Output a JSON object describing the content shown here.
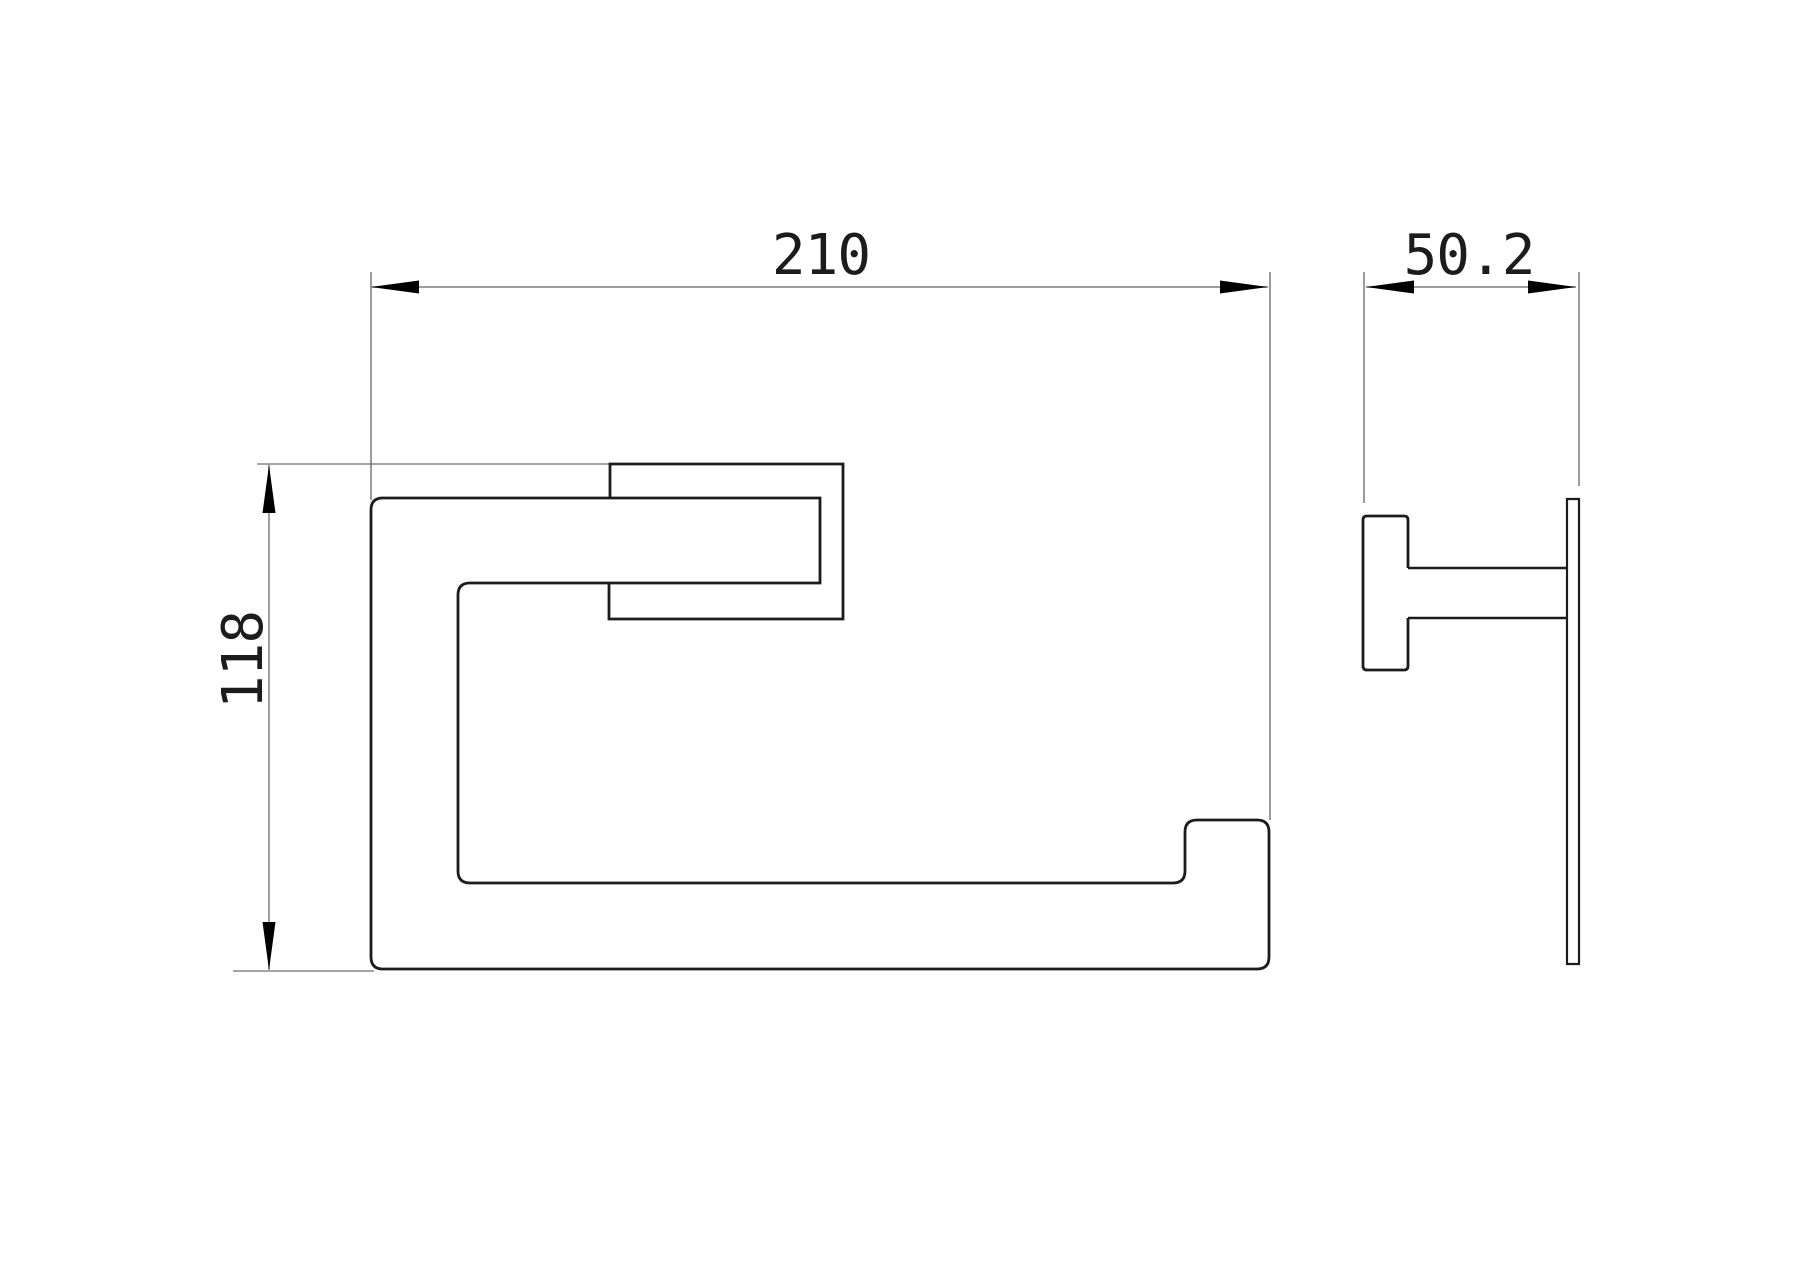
{
  "colors": {
    "background": "#ffffff",
    "outline": "#1c1c1c",
    "ext_line": "#4a4a4a",
    "dim_line": "#8f8f8f",
    "arrow": "#000000",
    "text": "#1c1c1c"
  },
  "dimensions": [
    {
      "id": "overall-width",
      "label": "210"
    },
    {
      "id": "overall-height",
      "label": "118"
    },
    {
      "id": "overall-depth",
      "label": "50.2"
    }
  ],
  "front_view": {
    "segments": [
      {
        "name": "bar-outline",
        "d": "M 820 498 L 383 498 Q 371 498 371 510 L 371 957 Q 371 969 383 969 L 1257 969 Q 1269 969 1269 957 L 1269 832 Q 1269 820 1257 820 L 1197 820 Q 1185 820 1185 832 L 1185 871 Q 1185 883 1173 883 L 470 883 Q 458 883 458 871 L 458 595 Q 458 583 470 583 L 820 583 Z",
        "w": 2.8,
        "stroke": "outline"
      },
      {
        "name": "hook-end-outline",
        "d": "M 610 498 L 610 464 L 843 464 L 843 619 L 609 619 L 609 583",
        "w": 2.8,
        "stroke": "outline"
      }
    ]
  },
  "side_view": {
    "segments": [
      {
        "name": "wall-bracket-outline",
        "d": "M 1408 568 L 1408 520 Q 1408 516 1404 516 L 1367 516 Q 1363 516 1363 520 L 1363 666 Q 1363 670 1367 670 L 1404 670 Q 1408 670 1408 666 L 1408 618",
        "w": 2.8,
        "stroke": "outline"
      },
      {
        "name": "mount-arm-top",
        "d": "M 1408 568 L 1567 568",
        "w": 2.6,
        "stroke": "outline"
      },
      {
        "name": "mount-arm-bottom",
        "d": "M 1408 618 L 1567 618",
        "w": 2.6,
        "stroke": "outline"
      },
      {
        "name": "bar-side-profile",
        "d": "M 1567 964 L 1567 499 L 1579 499 L 1579 964 Z",
        "w": 2.2,
        "stroke": "outline"
      }
    ]
  },
  "dimension_graphics": {
    "extension_lines": [
      {
        "name": "ext-line-210-left",
        "d": "M 371 272 L 371 500"
      },
      {
        "name": "ext-line-210-right",
        "d": "M 1270 272 L 1270 820"
      },
      {
        "name": "ext-line-118-top",
        "d": "M 257 464 L 610 464"
      },
      {
        "name": "ext-line-118-bottom",
        "d": "M 233 971 L 374 971"
      },
      {
        "name": "ext-line-50-left",
        "d": "M 1364 272 L 1364 503"
      },
      {
        "name": "ext-line-50-right",
        "d": "M 1579 272 L 1579 486"
      }
    ],
    "dimension_lines": [
      {
        "name": "dim-line-210",
        "d": "M 371 287 L 1268 287"
      },
      {
        "name": "dim-line-118",
        "d": "M 269 465 L 269 970"
      },
      {
        "name": "dim-line-50",
        "d": "M 1366 287 L 1576 287"
      }
    ],
    "arrowheads": [
      {
        "name": "arrowhead-210-left",
        "points": "371,287 419,280.5 419,293.5"
      },
      {
        "name": "arrowhead-210-right",
        "points": "1268,287 1220,280.5 1220,293.5"
      },
      {
        "name": "arrowhead-118-up",
        "points": "269,465 262.5,513 275.5,513"
      },
      {
        "name": "arrowhead-118-down",
        "points": "269,970 262.5,922 275.5,922"
      },
      {
        "name": "arrowhead-50-left",
        "points": "1366,287 1414,280.5 1414,293.5"
      },
      {
        "name": "arrowhead-50-right",
        "points": "1576,287 1528,280.5 1528,293.5"
      }
    ]
  }
}
